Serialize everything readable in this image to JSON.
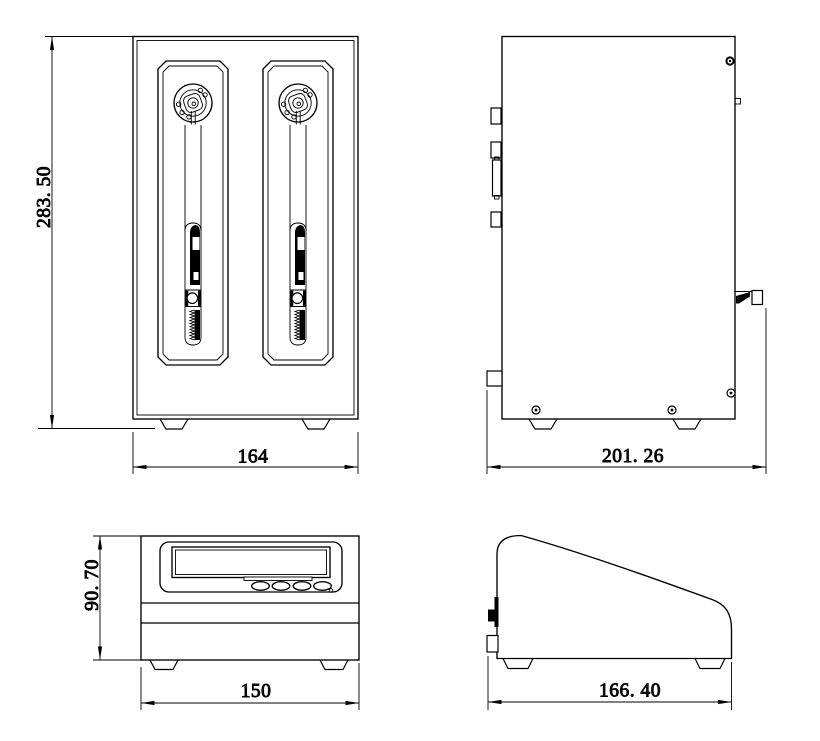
{
  "drawing": {
    "background_color": "#ffffff",
    "line_color": "#000000",
    "views": {
      "pump_front": {
        "dimensions": {
          "height": "283. 50",
          "width": "164"
        }
      },
      "pump_side": {
        "dimensions": {
          "depth": "201. 26"
        }
      },
      "controller_front": {
        "dimensions": {
          "height": "90. 70",
          "width": "150"
        }
      },
      "controller_side": {
        "dimensions": {
          "depth": "166. 40"
        }
      }
    }
  }
}
